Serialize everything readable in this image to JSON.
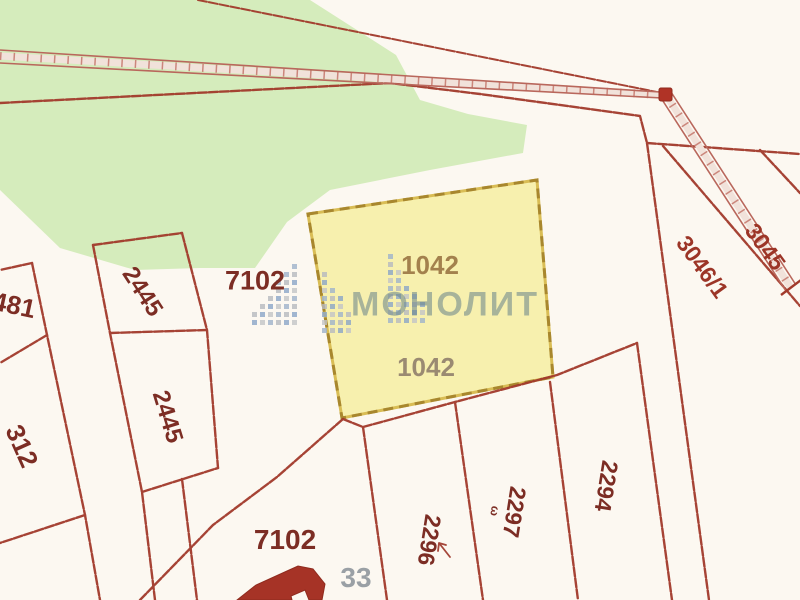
{
  "map": {
    "kind": "cadastral parcel map",
    "highlighted_parcel": {
      "number_top": "1042",
      "number_bottom": "1042"
    },
    "labels": {
      "p481": "481",
      "p2445_upper": "2445",
      "p2445_lower": "2445",
      "p312": "312",
      "p7102_top": "7102",
      "p3046_1": "3046/1",
      "p3045": "3045",
      "p2296": "2296",
      "p2297": "2297",
      "p2294": "2294",
      "p7102_bottom": "7102",
      "p33": "33",
      "omega_mark": "ω"
    },
    "watermark": {
      "brand": "МОНОЛИТ"
    },
    "colors": {
      "background": "#fcf8f1",
      "boundary_red": "#a23a2b",
      "green_area": "#d5ecbc",
      "highlight_fill": "#f7f0ae",
      "highlight_border": "#a8872e",
      "label_dark_red": "#7c2d24",
      "label_gold": "#a3814d",
      "label_gray": "#9aa0a5",
      "building_red": "#a63326",
      "watermark_gray_blue": "#6d868c",
      "logo_blue": "#8ba6c8",
      "logo_gray": "#b7bac0"
    }
  }
}
